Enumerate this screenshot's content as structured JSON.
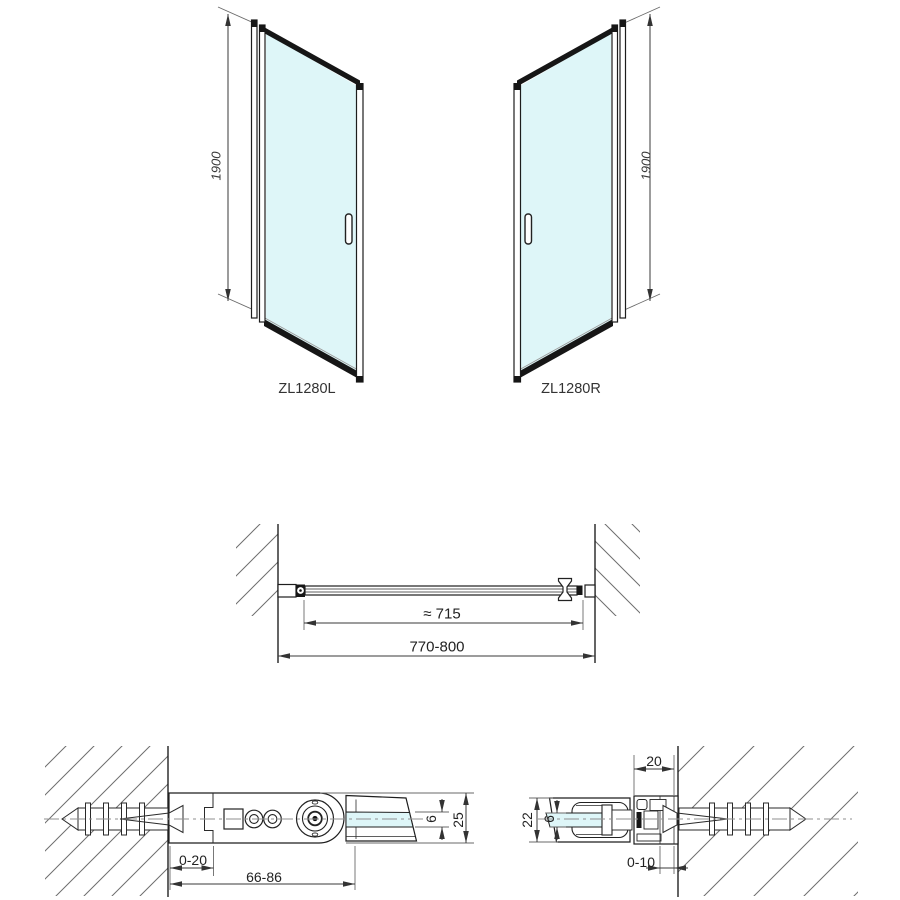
{
  "doors": {
    "left": {
      "model": "ZL1280L",
      "height_dim": "1900"
    },
    "right": {
      "model": "ZL1280R",
      "height_dim": "1900"
    }
  },
  "plan_view": {
    "glass_width_dim": "≈ 715",
    "adjust_range_dim": "770-800"
  },
  "hinge_detail": {
    "wall_adjust_dim": "0-20",
    "mount_range_dim": "66-86",
    "glass_thickness_dim": "6",
    "profile_depth_dim": "25"
  },
  "wall_profile_detail": {
    "profile_width_dim": "20",
    "profile_depth_dim": "22",
    "glass_thickness_dim": "6",
    "wall_gap_dim": "0-10"
  },
  "colors": {
    "glass": "#def6f8",
    "outline": "#1d1d1d",
    "hatch": "#6e6e6e",
    "dimension": "#333333"
  }
}
